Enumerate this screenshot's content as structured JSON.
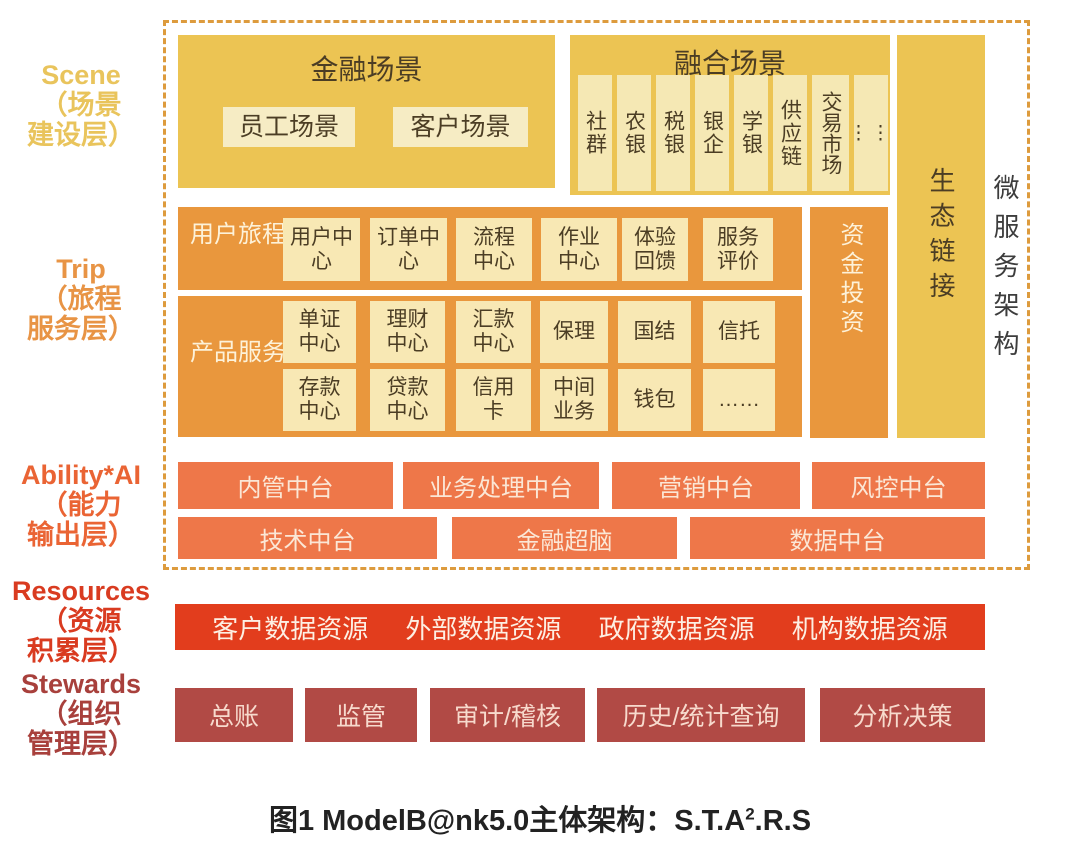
{
  "side_labels": {
    "scene": {
      "text": "Scene\n（场景\n建设层）"
    },
    "trip": {
      "text": "Trip\n（旅程\n服务层）"
    },
    "ability": {
      "text": "Ability*AI\n（能力\n输出层）"
    },
    "resources": {
      "text": "Resources\n（资源\n积累层）"
    },
    "stewards": {
      "text": "Stewards\n（组织\n管理层）"
    }
  },
  "scene_row": {
    "finance": {
      "title": "金融场景",
      "cells": [
        "员工场景",
        "客户场景"
      ]
    },
    "fusion": {
      "title": "融合场景",
      "cells": [
        "社群",
        "农银",
        "税银",
        "银企",
        "学银",
        "供应链",
        "交易市场"
      ],
      "ellipsis": "⋮⋮"
    },
    "eco_link": "生态链接",
    "microservice": "微服务架构"
  },
  "trip_row": {
    "journey": {
      "label": "用户旅程",
      "cells": [
        "用户中心",
        "订单中心",
        "流程中心",
        "作业中心",
        "体验回馈",
        "服务评价"
      ]
    },
    "product": {
      "label": "产品服务",
      "row1": [
        "单证中心",
        "理财中心",
        "汇款中心",
        "保理",
        "国结",
        "信托"
      ],
      "row2": [
        "存款中心",
        "贷款中心",
        "信用卡",
        "中间业务",
        "钱包",
        "……"
      ]
    },
    "capital": "资金投资"
  },
  "ability_row": {
    "row1": [
      "内管中台",
      "业务处理中台",
      "营销中台",
      "风控中台"
    ],
    "row2": [
      "技术中台",
      "金融超脑",
      "数据中台"
    ]
  },
  "resources_row": [
    "客户数据资源",
    "外部数据资源",
    "政府数据资源",
    "机构数据资源"
  ],
  "stewards_row": [
    "总账",
    "监管",
    "审计/稽核",
    "历史/统计查询",
    "分析决策"
  ],
  "caption": {
    "prefix": "图1  ModelB@nk5.0主体架构：S.T.A",
    "sup": "2",
    "suffix": ".R.S"
  },
  "colors": {
    "gold": "#ecc453",
    "gold_cell": "#f6ecc4",
    "fusion_cell": "#f5e8b4",
    "orange": "#e9973d",
    "orange_cell": "#f8e8b4",
    "coral": "#ee7749",
    "resources_red": "#e23d1d",
    "stewards_brick": "#b14a45",
    "dashed_border": "#dd9b3d",
    "dark_text": "#4b3d24",
    "cream_text": "#fdf2d9",
    "micro_text": "#3d3d3d",
    "label_scene": "#e9c45c",
    "label_trip": "#e89445",
    "label_ability": "#ea6434",
    "label_resources": "#d93b20",
    "label_stewards": "#a8403c"
  }
}
